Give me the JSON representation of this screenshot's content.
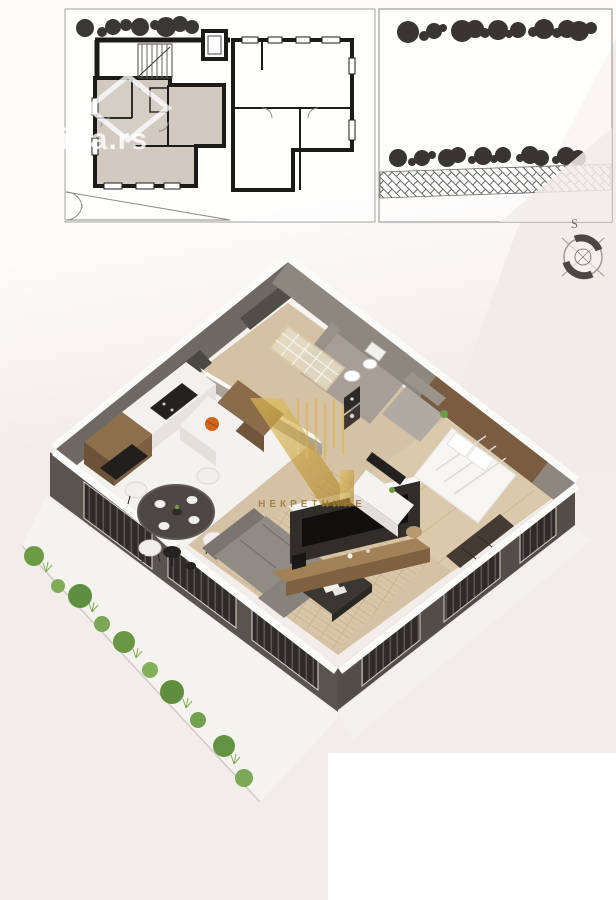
{
  "watermarks": {
    "portal": "ida.rs",
    "agency_name": "НЕКРЕТНИНЕ"
  },
  "compass": {
    "north_label": "S"
  },
  "palette": {
    "page_background": "#f2ede9",
    "panel_white": "#ffffff",
    "plan_wall": "#1d1b19",
    "highlighted_unit": "#d2cac1",
    "tree": "#3a3836",
    "exterior_wall": "#57524c",
    "wall_cap": "#fafaf8",
    "hall_floor": "#d5c2a5",
    "kitchen_floor": "#f3f2ef",
    "living_floor": "#d8c5a7",
    "bedroom_floor": "#dbc9ac",
    "sofa_gray": "#908c86",
    "wood_furniture": "#8e6f4c",
    "plant_green": "#6c9b45",
    "logo_gold": "#c9a23a",
    "accent_orange": "#d2641e"
  },
  "plan_2d": {
    "units": [
      "highlighted-apartment",
      "adjacent-apartment"
    ],
    "elements": [
      "trees-row",
      "staircase",
      "elevator",
      "window-openings",
      "yard-gates"
    ]
  },
  "garden_plan": {
    "rows_of_trees": 2,
    "paving": "herringbone-path"
  },
  "render_3d": {
    "rooms": [
      "entry-hall",
      "bathroom",
      "hallway",
      "kitchen",
      "dining-area",
      "living-room",
      "bedroom",
      "terrace-garden"
    ],
    "furniture": [
      "kitchen-cabinets",
      "round-dining-table",
      "four-chairs",
      "l-shaped-sofa",
      "coffee-table",
      "tv-media-wall",
      "double-bed",
      "desk",
      "wardrobe",
      "toilet",
      "washbasin",
      "terrace-bistro-table",
      "planter-shrubs"
    ]
  }
}
